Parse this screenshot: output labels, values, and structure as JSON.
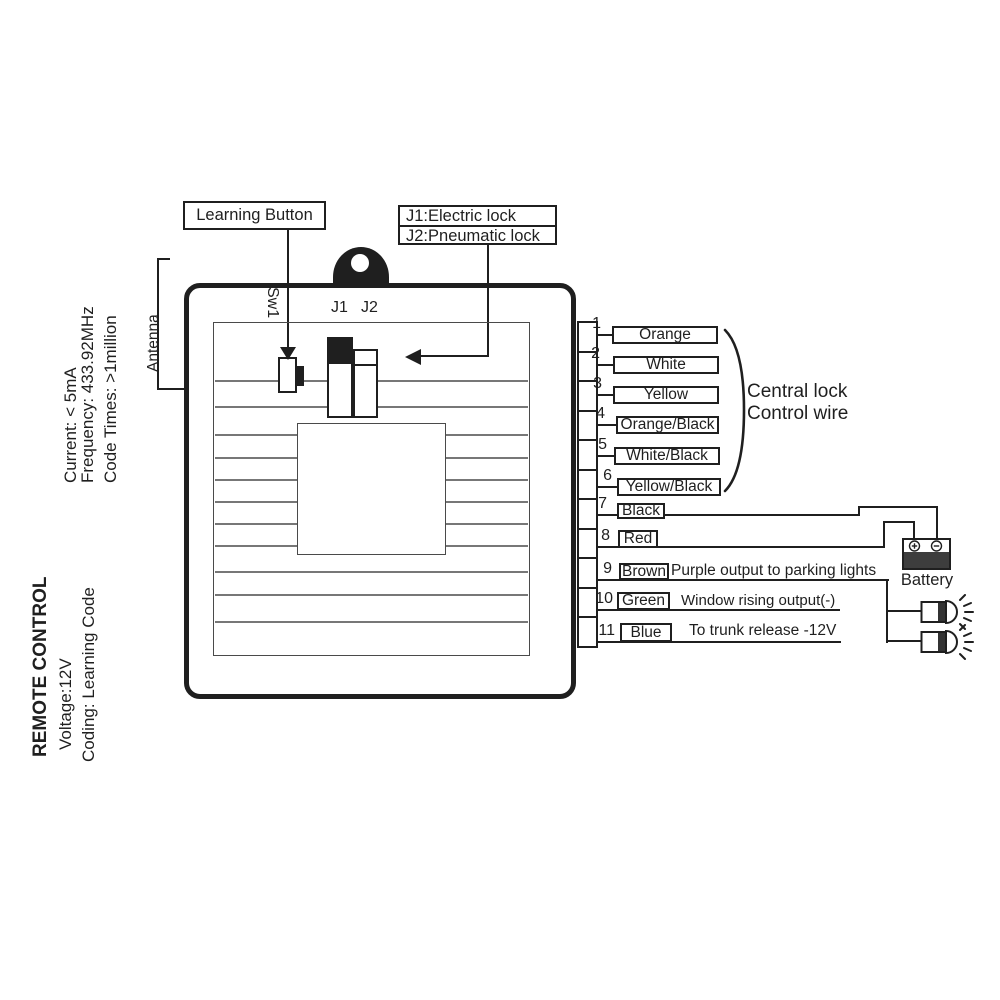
{
  "palette": {
    "ink": "#1f1f1f",
    "paper": "#ffffff",
    "battery_fill": "#3d3d3d"
  },
  "specs_top": {
    "current": "Current:  < 5mA",
    "frequency": "Frequency: 433.92MHz",
    "code_times": "Code Times: >1million"
  },
  "specs_bottom": {
    "title": "REMOTE CONTROL",
    "voltage": "Voltage:12V",
    "coding": "Coding: Learning Code"
  },
  "antenna_label": "Antenna",
  "callouts": {
    "learning_button": "Learning Button",
    "j1": "J1:Electric lock",
    "j2": "J2:Pneumatic lock"
  },
  "board": {
    "sw1": "Sw1",
    "j1": "J1",
    "j2": "J2"
  },
  "wires": [
    {
      "num": "1",
      "color": "Orange",
      "note": ""
    },
    {
      "num": "2",
      "color": "White",
      "note": ""
    },
    {
      "num": "3",
      "color": "Yellow",
      "note": ""
    },
    {
      "num": "4",
      "color": "Orange/Black",
      "note": ""
    },
    {
      "num": "5",
      "color": "White/Black",
      "note": ""
    },
    {
      "num": "6",
      "color": "Yellow/Black",
      "note": ""
    },
    {
      "num": "7",
      "color": "Black",
      "note": ""
    },
    {
      "num": "8",
      "color": "Red",
      "note": ""
    },
    {
      "num": "9",
      "color": "Brown",
      "note": "Purple output to parking lights"
    },
    {
      "num": "10",
      "color": "Green",
      "note": "Window rising output(-)"
    },
    {
      "num": "11",
      "color": "Blue",
      "note": "To trunk release -12V"
    }
  ],
  "group_label": {
    "line1": "Central lock",
    "line2": "Control wire"
  },
  "battery": {
    "label": "Battery",
    "plus_symbol": "⊕",
    "minus_symbol": "⊖"
  }
}
